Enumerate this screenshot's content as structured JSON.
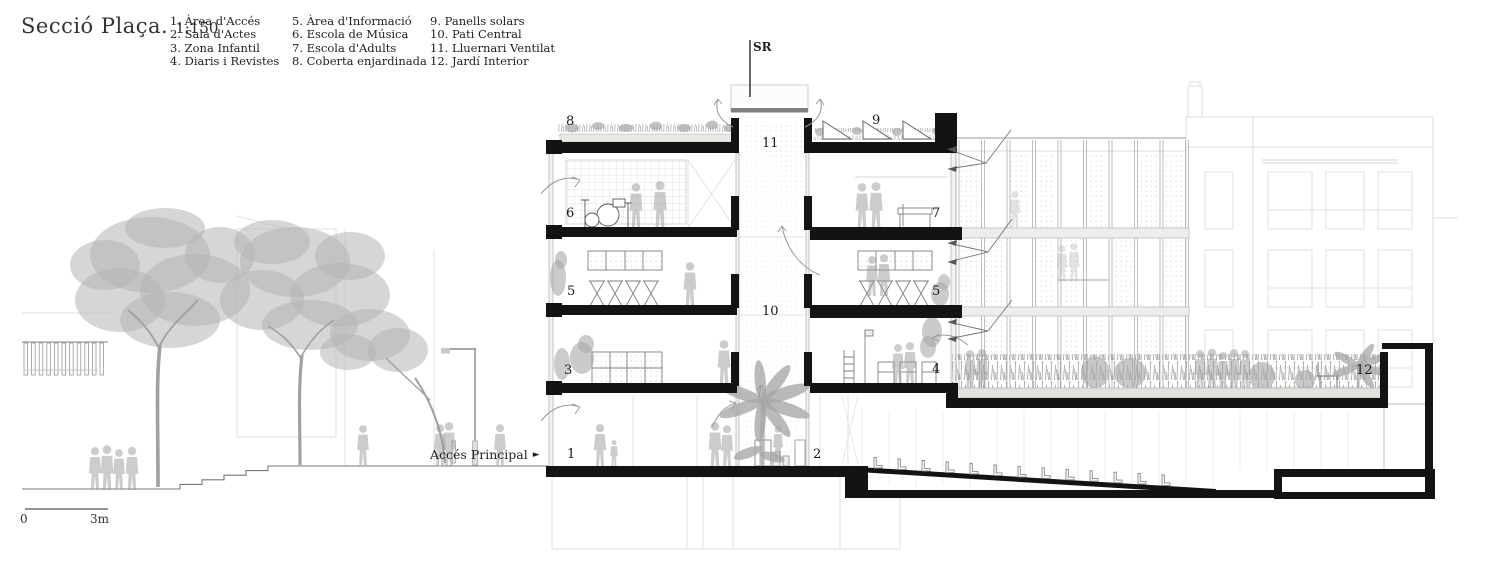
{
  "title": {
    "main": "Secció Plaça.",
    "scale": "1:150"
  },
  "legend": {
    "col1": [
      "1. Àrea d'Accés",
      "2. Sala d'Actes",
      "3. Zona Infantil",
      "4. Diaris i Revistes"
    ],
    "col2": [
      "5. Àrea d'Informació",
      "6. Escola de Música",
      "7. Escola d'Adults",
      "8. Coberta enjardinada"
    ],
    "col3": [
      "9. Panells solars",
      "10. Pati Central",
      "11. Lluernari Ventilat",
      "12. Jardí Interior"
    ]
  },
  "markers": {
    "sr": "SR",
    "n1": "1",
    "n2": "2",
    "n3": "3",
    "n4": "4",
    "n5_left": "5",
    "n5_right": "5",
    "n6": "6",
    "n7": "7",
    "n8": "8",
    "n9": "9",
    "n10": "10",
    "n11": "11",
    "n12": "12"
  },
  "annotations": {
    "access_label": "Accés Principal",
    "access_arrow": "►"
  },
  "scale_bar": {
    "start": "0",
    "end": "3m"
  },
  "colors": {
    "paper": "#ffffff",
    "cut_ink": "#131313",
    "line_dark": "#555555",
    "line_mid": "#999999",
    "line_light": "#cccccc",
    "line_faint": "#e2e2e0",
    "people_gray": "#9a9a9a",
    "vegetation_gray": "#b4b4b4"
  }
}
